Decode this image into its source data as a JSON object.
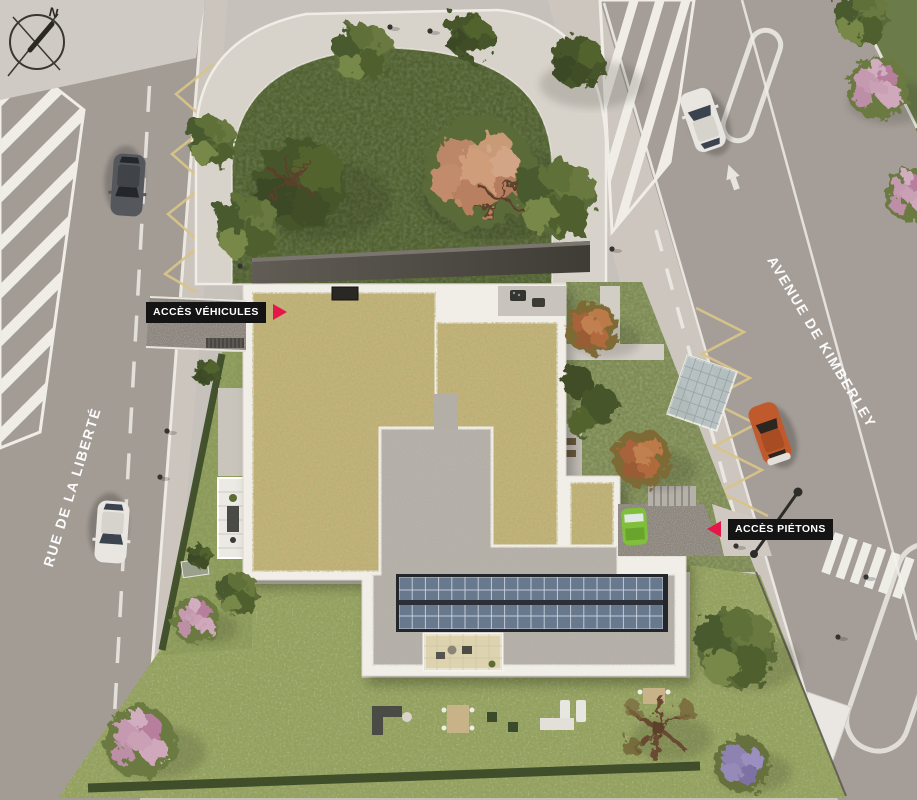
{
  "compass": {
    "north_label": "N"
  },
  "streets": {
    "left": "RUE DE LA LIBERTÉ",
    "right": "AVENUE DE KIMBERLEY"
  },
  "access": {
    "vehicles": "ACCÈS VÉHICULES",
    "pedestrians": "ACCÈS PIÉTONS"
  },
  "colors": {
    "accent_red": "#E5164A",
    "label_background": "#141414",
    "label_text": "#FFFFFF",
    "road_asphalt": "#A39C95",
    "sidewalk": "#CBC5BE",
    "lawn_green": "#93A05C",
    "park_green": "#51602F",
    "sedum_roof": "#C0B274",
    "roof_gravel": "#B3AEA6",
    "parapet_white": "#F1EEE8",
    "solar_panel_blue": "#68798E",
    "marking_yellow": "#D8C488",
    "canopy_dark": "#57534C"
  }
}
